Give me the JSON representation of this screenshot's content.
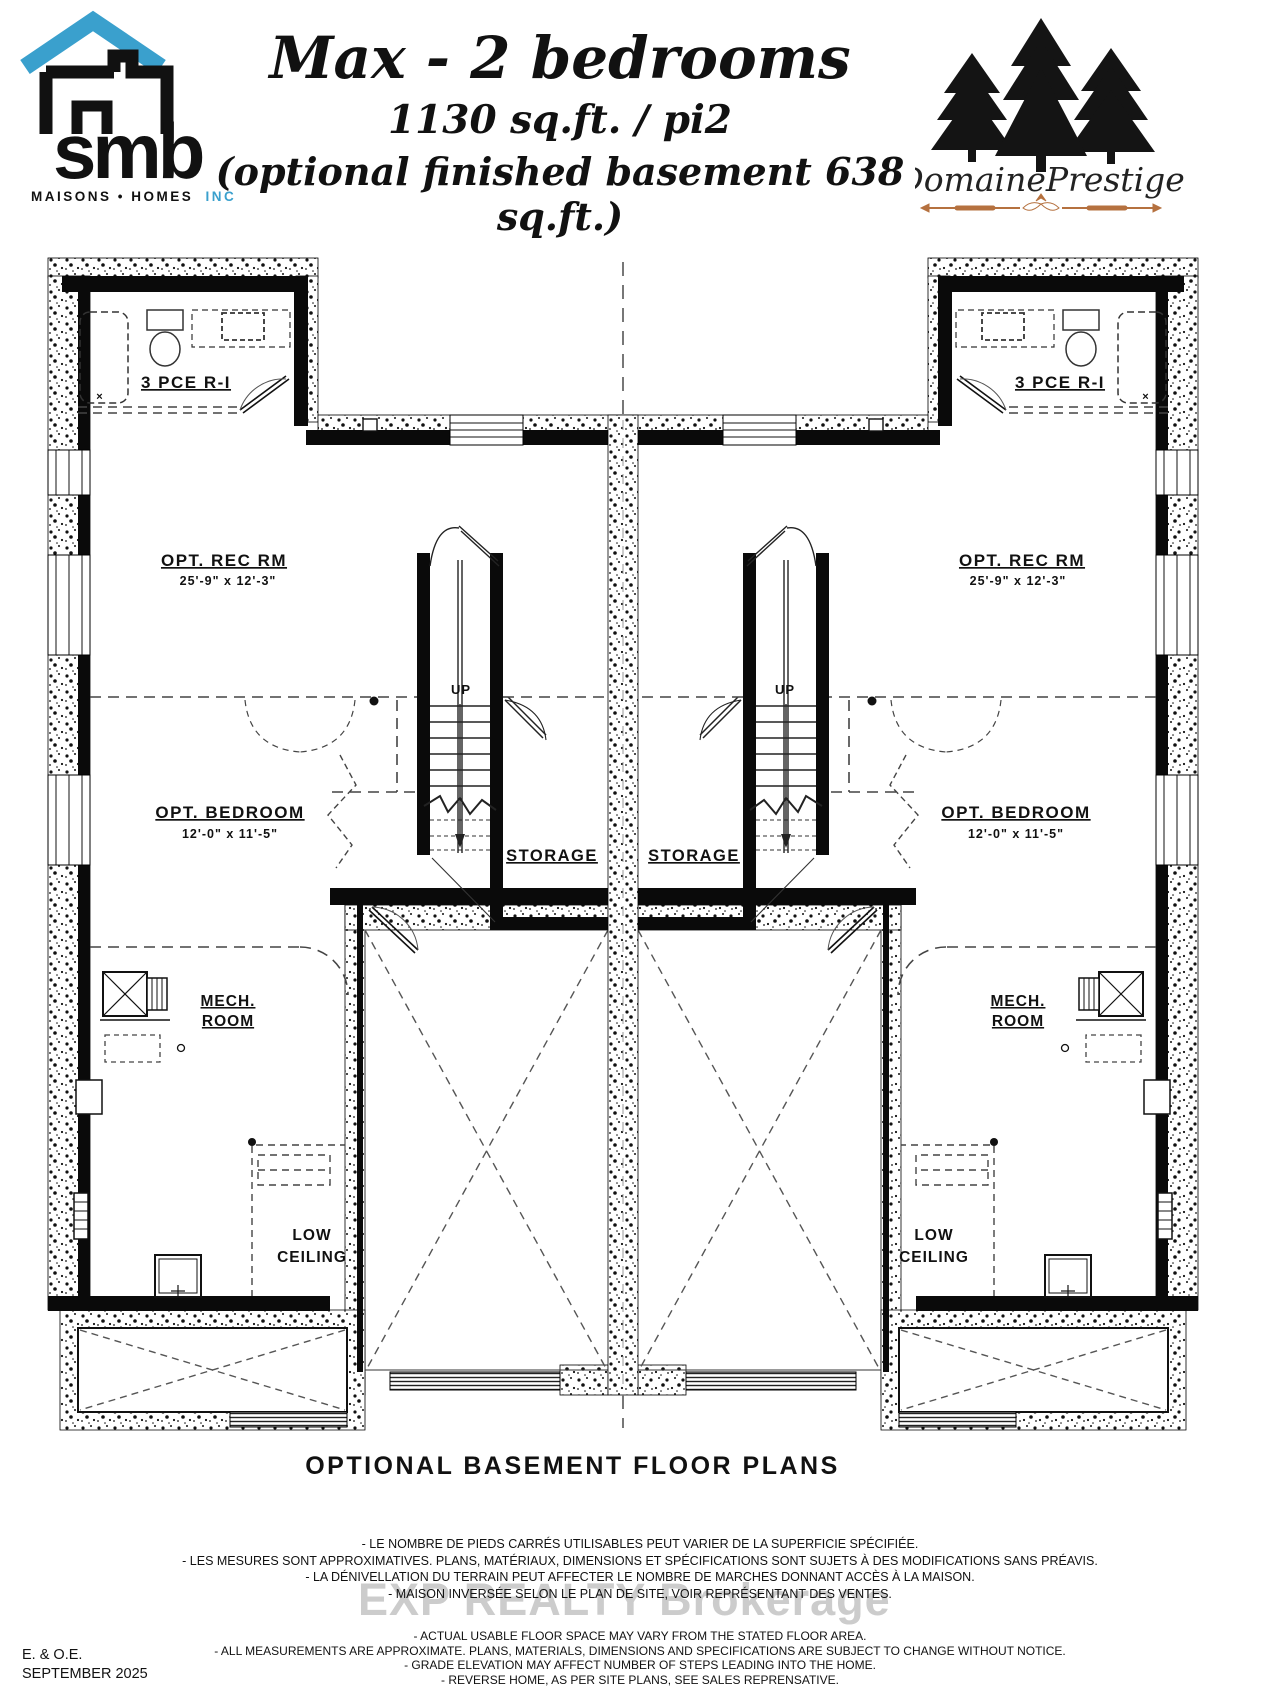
{
  "branding": {
    "smb_logo": {
      "word": "smb",
      "tagline": "MAISONS • HOMES",
      "inc": "INC.",
      "roof_color": "#3aa0cd",
      "text_color": "#111111"
    },
    "domaine_logo": {
      "name": "DomainePrestige",
      "tree_color": "#141414",
      "ornament_color": "#b5713f"
    }
  },
  "header": {
    "title": "Max - 2 bedrooms",
    "subtitle": "1130 sq.ft. / pi2",
    "subtitle2": "(optional finished basement 638 sq.ft.)"
  },
  "plan": {
    "title": "OPTIONAL BASEMENT FLOOR PLANS",
    "rooms": {
      "bathroom": "3 PCE R-I",
      "rec_room": "OPT. REC RM",
      "rec_room_dims": "25'-9\" x 12'-3\"",
      "bedroom": "OPT. BEDROOM",
      "bedroom_dims": "12'-0\" x 11'-5\"",
      "storage": "STORAGE",
      "mech_line1": "MECH.",
      "mech_line2": "ROOM",
      "low_line1": "LOW",
      "low_line2": "CEILING",
      "up": "UP",
      "tub_mark": "×"
    }
  },
  "watermark": "EXP REALTY  Brokerage",
  "disclaimers_fr": [
    "- LE NOMBRE DE PIEDS CARRÉS UTILISABLES PEUT VARIER DE LA SUPERFICIE SPÉCIFIÉE.",
    "- LES MESURES SONT APPROXIMATIVES.  PLANS, MATÉRIAUX, DIMENSIONS ET SPÉCIFICATIONS SONT SUJETS À DES MODIFICATIONS SANS PRÉAVIS.",
    "- LA DÉNIVELLATION DU TERRAIN PEUT AFFECTER LE NOMBRE DE MARCHES DONNANT ACCÈS À LA MAISON.",
    "- MAISON INVERSÉE SELON LE PLAN DE SITE, VOIR REPRÉSENTANT DES VENTES."
  ],
  "disclaimers_en": [
    "- ACTUAL USABLE FLOOR SPACE MAY VARY FROM THE STATED FLOOR AREA.",
    "- ALL MEASUREMENTS ARE APPROXIMATE.  PLANS, MATERIALS, DIMENSIONS AND SPECIFICATIONS ARE SUBJECT TO CHANGE WITHOUT NOTICE.",
    "- GRADE ELEVATION MAY AFFECT NUMBER OF STEPS LEADING INTO THE HOME.",
    "- REVERSE HOME, AS PER SITE PLANS, SEE SALES REPRENSATIVE."
  ],
  "footer": {
    "eoe": "E. & O.E.",
    "date": "SEPTEMBER 2025"
  }
}
